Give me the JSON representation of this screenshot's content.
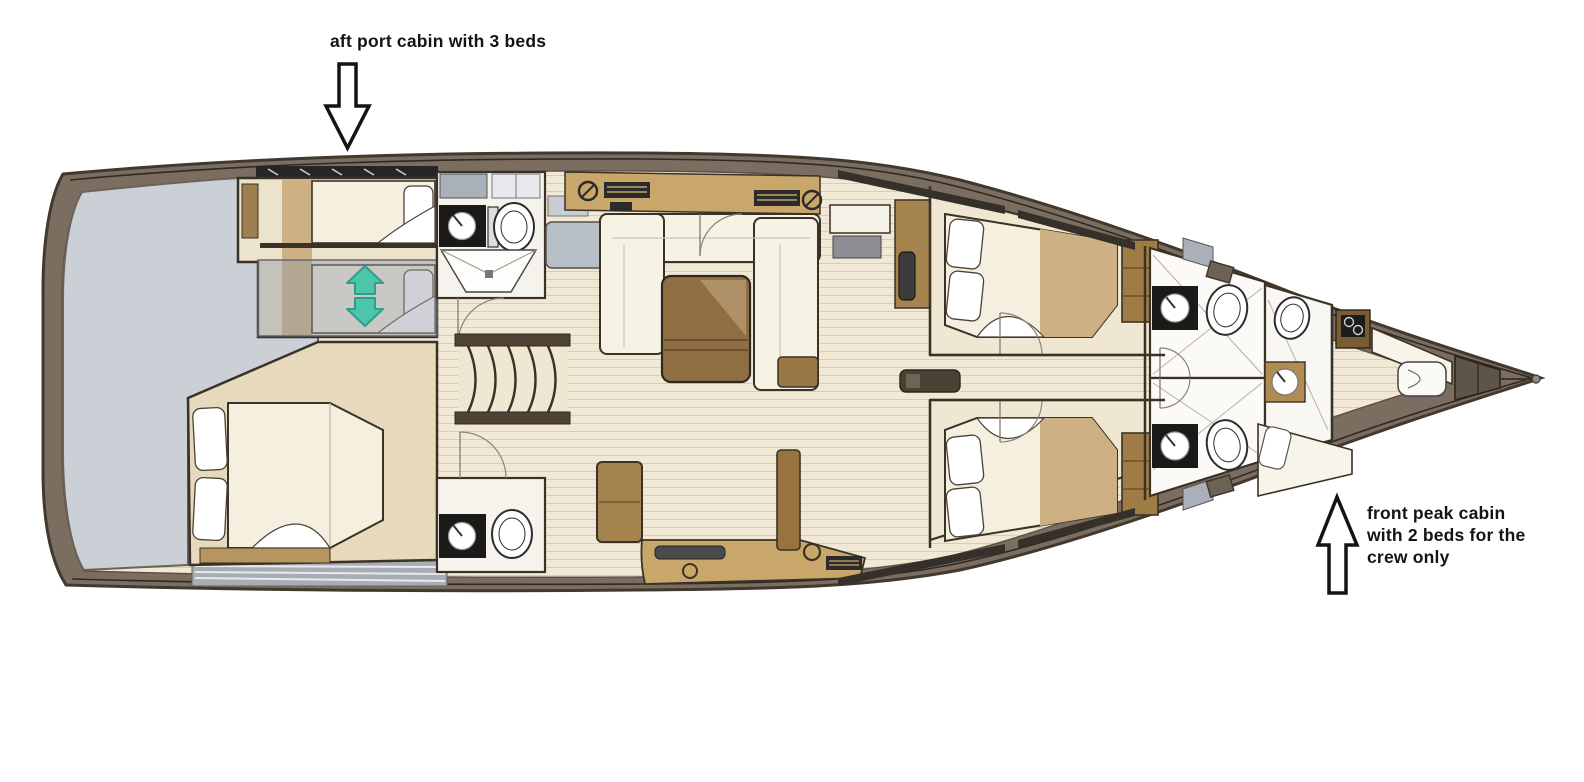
{
  "annotations": {
    "aft_cabin": {
      "text": "aft port cabin with 3 beds"
    },
    "front_cabin": {
      "lines": [
        "front peak cabin",
        "with 2 beds for the",
        "crew only"
      ]
    }
  },
  "icons": {
    "aft_pointer": "down-arrow-icon",
    "front_pointer": "up-arrow-icon",
    "sliding_bed": "slide-up-down-arrows-icon"
  },
  "colors": {
    "background": "#ffffff",
    "hull_band": "#7b6e60",
    "hull_outline": "#41382e",
    "deck_rail": "#2e2a23",
    "interior_floor": "#f1e9d6",
    "plank_line": "#d9cdb2",
    "deck_gray": "#cbcfd6",
    "room_cream": "#ece3cd",
    "mattress": "#f4efde",
    "pillow_white": "#ffffff",
    "furniture_tan": "#c9a76a",
    "wood_brown": "#97743f",
    "wood_dark": "#7a5c33",
    "fixture_black": "#1b1a18",
    "appliance_gray": "#aab0ba",
    "overlay_gray": "rgba(148,154,167,0.45)",
    "slide_arrow_teal": "#4cc5ab",
    "slide_arrow_teal_dark": "#2f9e88",
    "annotation_black": "#141414"
  }
}
